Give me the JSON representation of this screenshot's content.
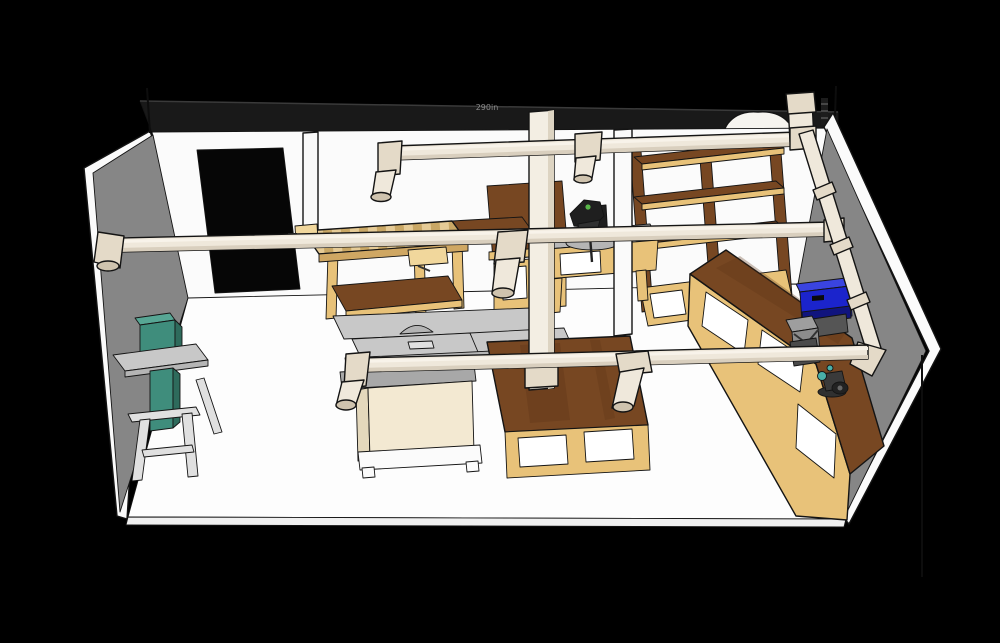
{
  "annotation": {
    "dimension_label": "290in"
  },
  "colors": {
    "background": "#000000",
    "wall_band": "#191919",
    "band_edge": "#3a3a3a",
    "wall_white": "#fbfbfb",
    "wall_gray": "#868686",
    "floor_white": "#fdfdfd",
    "floor_edge": "#f0f0f0",
    "door_black": "#060606",
    "wall_base_line": "#9a9a9a",
    "pipe": "#efe8db",
    "pipe_light": "#f8f3ea",
    "pipe_shade": "#d9cfbe",
    "pipe_fitting": "#e4dac8",
    "pipe_end": "#cfc3ae",
    "pipe_drop": "#f3eee3",
    "pipe_drop_shade": "#ddd4c2",
    "post_white": "#fafafa",
    "wood_dark": "#774722",
    "wood_darker": "#5e3517",
    "plywood": "#e8c279",
    "plywood_light": "#f1d79c",
    "apron": "#cfa763",
    "butcher_light": "#e6cb96",
    "butcher_dark": "#c9a765",
    "metal_light": "#c8c8c8",
    "metal_mid": "#b5b5b5",
    "metal_dark": "#a8a8a8",
    "saw_cream": "#f3e9d2",
    "saw_cream_side": "#e4d8bc",
    "stand_white": "#fbfbfb",
    "bandsaw_teal": "#3f8d7c",
    "bandsaw_teal_light": "#57a694",
    "bandsaw_teal_dark": "#2e6b5c",
    "stand_gray": "#e0e0e0",
    "miter_gray": "#b8b8b8",
    "saw_black": "#1f1f1f",
    "saw_black2": "#303030",
    "saw_green_dot": "#58b548",
    "planer_blue": "#1b24cc",
    "planer_blue_top": "#3a44e0",
    "planer_blue_dark": "#10147e",
    "planer_base": "#555555",
    "tool_gray": "#9e9e9e",
    "tool_gray_dark": "#8c8c8c",
    "tool_box": "#4a4a4a",
    "tool_dark": "#3a3a3a",
    "grinder_teal": "#49b0a8",
    "white": "#ffffff",
    "blob_white": "#f6f4ef"
  },
  "equipment": {
    "band_saw": "band saw",
    "workbench": "workbench",
    "table_saw": "table saw",
    "assembly_table": "assembly table",
    "miter_station": "miter saw station",
    "shelving": "storage shelving",
    "corner_bench": "corner workbench",
    "planer": "benchtop planer",
    "grinder": "bench grinder",
    "dust_collector": "dust collector",
    "ductwork": "dust collection ductwork"
  }
}
